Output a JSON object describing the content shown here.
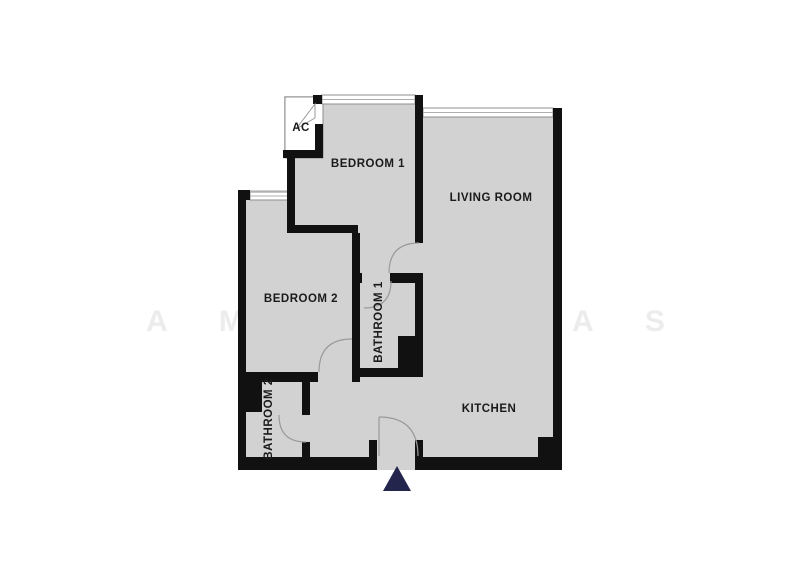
{
  "floorplan": {
    "rooms": {
      "ac_closet": {
        "label": "AC"
      },
      "bedroom1": {
        "label": "BEDROOM 1"
      },
      "living_room": {
        "label": "LIVING ROOM"
      },
      "bedroom2": {
        "label": "BEDROOM 2"
      },
      "bathroom1": {
        "label": "BATHROOM 1"
      },
      "bathroom2": {
        "label": "BATHROOM 2"
      },
      "kitchen": {
        "label": "KITCHEN"
      }
    },
    "watermark": {
      "left": "A M E",
      "right": "A S"
    },
    "entrance": {
      "marker": "up-triangle"
    },
    "colors": {
      "background": "#ffffff",
      "floor": "#d2d2d2",
      "wall": "#111111",
      "door_line": "#9a9a9a",
      "entrance_marker": "#23254d",
      "watermark": "#ececec",
      "label_text": "#1a1a1a"
    }
  }
}
